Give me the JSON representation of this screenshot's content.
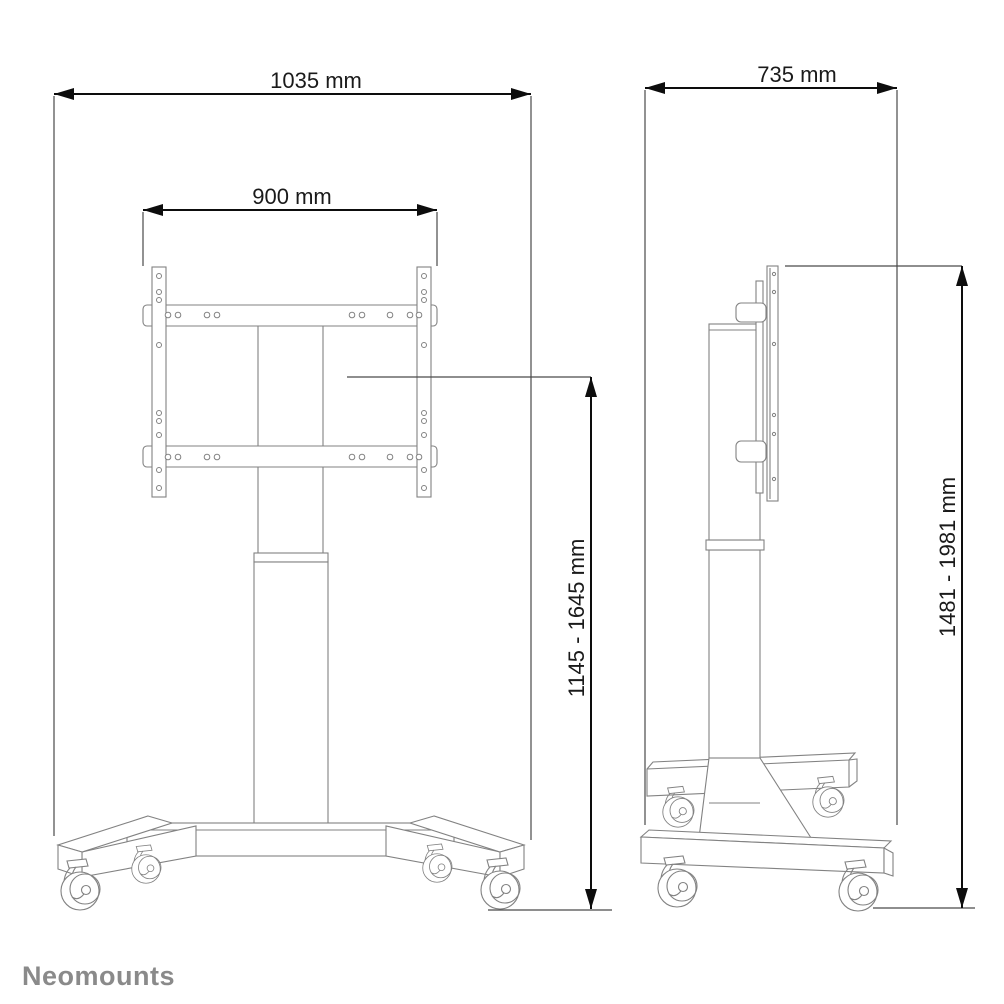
{
  "drawing": {
    "brand": "Neomounts",
    "views": {
      "front": {
        "total_width": "1035 mm",
        "bracket_width": "900 mm",
        "height_range": "1145 - 1645 mm"
      },
      "side": {
        "total_depth": "735 mm",
        "height_range": "1481 - 1981 mm"
      }
    },
    "colors": {
      "outline": "#828282",
      "dimension": "#0d0d0d",
      "brand_text": "#8a8a8a",
      "background": "#ffffff"
    }
  }
}
